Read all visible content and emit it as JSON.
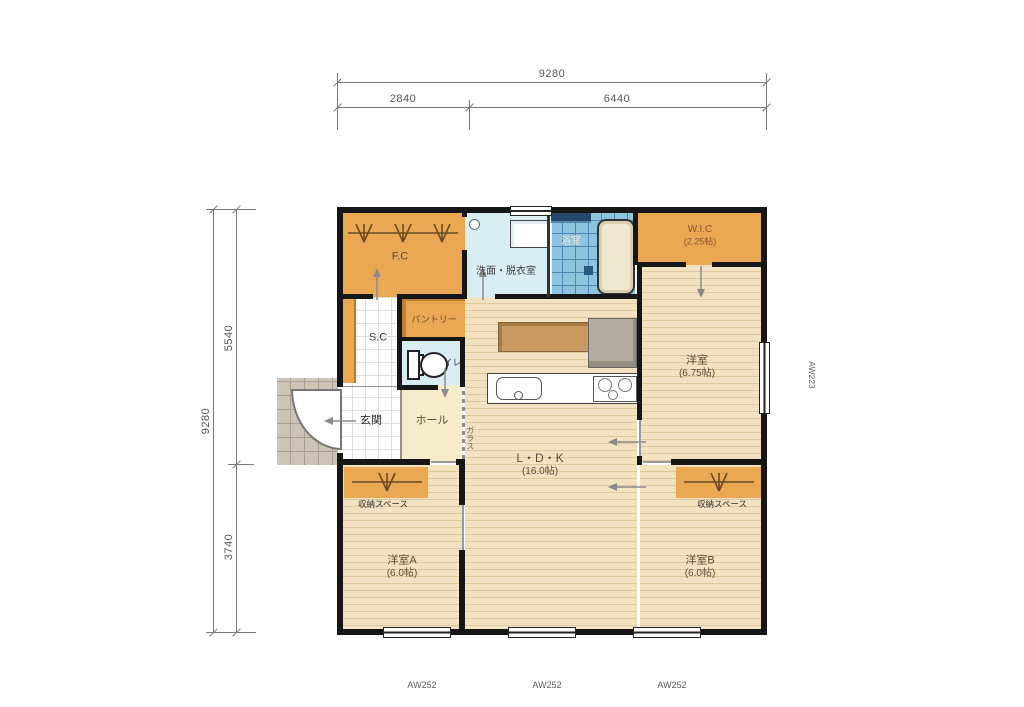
{
  "title": "1LDK+2居室 平面図",
  "dimensions": {
    "top": {
      "total": "9280",
      "seg1": "2840",
      "seg2": "6440"
    },
    "left": {
      "total": "9280",
      "seg1": "5540",
      "seg2": "3740"
    }
  },
  "rooms": {
    "fc": {
      "name": "F.C"
    },
    "washroom": {
      "name": "洗面・脱衣室"
    },
    "bath": {
      "name": "浴室"
    },
    "wic": {
      "name": "W.I.C",
      "size": "(2.25帖)"
    },
    "shoe_closet": {
      "name": "S.C"
    },
    "pantry": {
      "name": "パントリー"
    },
    "toilet": {
      "name": "トイレ"
    },
    "entrance": {
      "name": "玄関"
    },
    "hall": {
      "name": "ホール"
    },
    "glass": {
      "name": "ガラス"
    },
    "ldk": {
      "name": "L・D・K",
      "size": "(16.0帖)"
    },
    "bedroom": {
      "name": "洋室",
      "size": "(6.75帖)"
    },
    "storage_a": {
      "name": "収納スペース"
    },
    "storage_b": {
      "name": "収納スペース"
    },
    "bedroom_a": {
      "name": "洋室A",
      "size": "(6.0帖)"
    },
    "bedroom_b": {
      "name": "洋室B",
      "size": "(6.0帖)"
    }
  },
  "window_codes": {
    "bottom": [
      "AW252",
      "AW252",
      "AW252"
    ],
    "right": "AW223"
  },
  "icons": {
    "toilet": "toilet-icon",
    "bathtub": "bathtub-icon",
    "vanity": "vanity-sink-icon",
    "kitchen_sink": "kitchen-sink-icon",
    "stove": "stove-icon",
    "fridge": "refrigerator-icon",
    "hanger_rod": "hanger-rod-icon",
    "door_swing": "door-swing-icon",
    "flow_arrow": "flow-arrow-icon"
  },
  "colors": {
    "c_orange": "#E9A851",
    "c_wood": "#F3E2C1",
    "c_wood_line": "#DFC89E",
    "c_water": "#D9EEF2",
    "c_bath": "#8FC4DE",
    "c_bathline": "#4E86B4",
    "c_cream": "#F6EBCB",
    "c_porch": "#CCC4B7",
    "c_wall": "#161616",
    "c_dim": "#7a7a7a",
    "c_label": "#5C4A36"
  }
}
